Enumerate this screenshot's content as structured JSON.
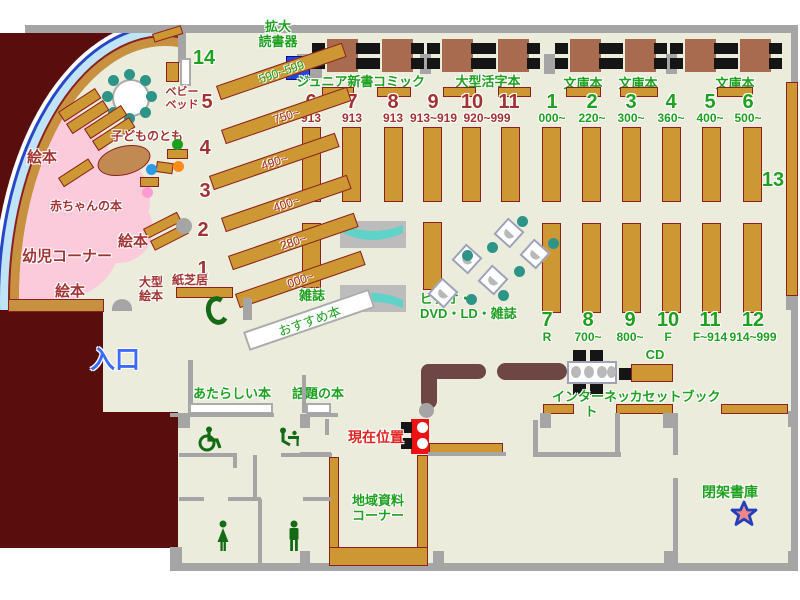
{
  "kids": {
    "toddler_corner": "幼児コーナー",
    "baby_books": "赤ちゃんの本",
    "kodomo_no_tomo": "子どものとも",
    "ehon_a": "絵本",
    "ehon_b": "絵本",
    "ehon_c": "絵本",
    "baby_bed": "ベビー\nベッド",
    "large_ehon": "大型\n絵本",
    "kamishibai": "紙芝居"
  },
  "entrance_label": "入口",
  "left_wing": {
    "shelves": [
      {
        "num": "14",
        "range": "590~599"
      },
      {
        "num": "5",
        "range": "750~"
      },
      {
        "num": "4",
        "range": "490~"
      },
      {
        "num": "3",
        "range": "400~"
      },
      {
        "num": "2",
        "range": "280~"
      },
      {
        "num": "1",
        "range": "000~"
      }
    ],
    "recommended": "おすすめ本"
  },
  "reading_area": {
    "magnifier": "拡大\n読書器",
    "sections": [
      "ジュニア新書",
      "コミック",
      "大型活字本",
      "文庫本",
      "文庫本",
      "文庫本"
    ]
  },
  "stacks": {
    "left_top": [
      {
        "num": "6",
        "range": "913"
      },
      {
        "num": "7",
        "range": "913"
      },
      {
        "num": "8",
        "range": "913"
      },
      {
        "num": "9",
        "range": "913~919"
      },
      {
        "num": "10",
        "range": ""
      },
      {
        "num": "11",
        "range": ""
      }
    ],
    "left_top_shared_range": "920~999",
    "right_top": [
      {
        "num": "1",
        "range": "000~"
      },
      {
        "num": "2",
        "range": "220~"
      },
      {
        "num": "3",
        "range": "300~"
      },
      {
        "num": "4",
        "range": "360~"
      },
      {
        "num": "5",
        "range": "400~"
      },
      {
        "num": "6",
        "range": "500~"
      }
    ],
    "right_bottom": [
      {
        "num": "7",
        "range": "R"
      },
      {
        "num": "8",
        "range": "700~"
      },
      {
        "num": "9",
        "range": "800~"
      },
      {
        "num": "10",
        "range": "F"
      },
      {
        "num": "11",
        "range": "F~914"
      },
      {
        "num": "12",
        "range": "914~999"
      }
    ],
    "thirteen": "13",
    "magazines": "雑誌",
    "av_corner": "ビデオ・\nDVD・LD・雑誌"
  },
  "services": {
    "internet": "インターネット",
    "cd": "CD",
    "cassette_books": "カセットブック",
    "new_books": "あたらしい本",
    "topic_books": "話題の本",
    "local_materials": "地域資料\nコーナー",
    "closed_stacks": "閉架書庫",
    "current_position": "現在位置"
  },
  "colors": {
    "floor": "#ECECDC",
    "wall": "#A5A5A5",
    "shelf_tan": "#CD9733",
    "shelf_border": "#8B2020",
    "kids_pink": "#FCCBDB",
    "staff_maroon": "#5A0D0D",
    "counter_brown": "#6E4646",
    "table_brown": "#A96B4F",
    "chair_teal": "#2E9488",
    "bench_teal": "#5FD3C8",
    "label_green": "#1FA01F",
    "label_dark_red": "#A33333",
    "marker_red": "#EE1111",
    "entrance_blue": "#3D6BFF",
    "device_blue": "#2244E0"
  }
}
